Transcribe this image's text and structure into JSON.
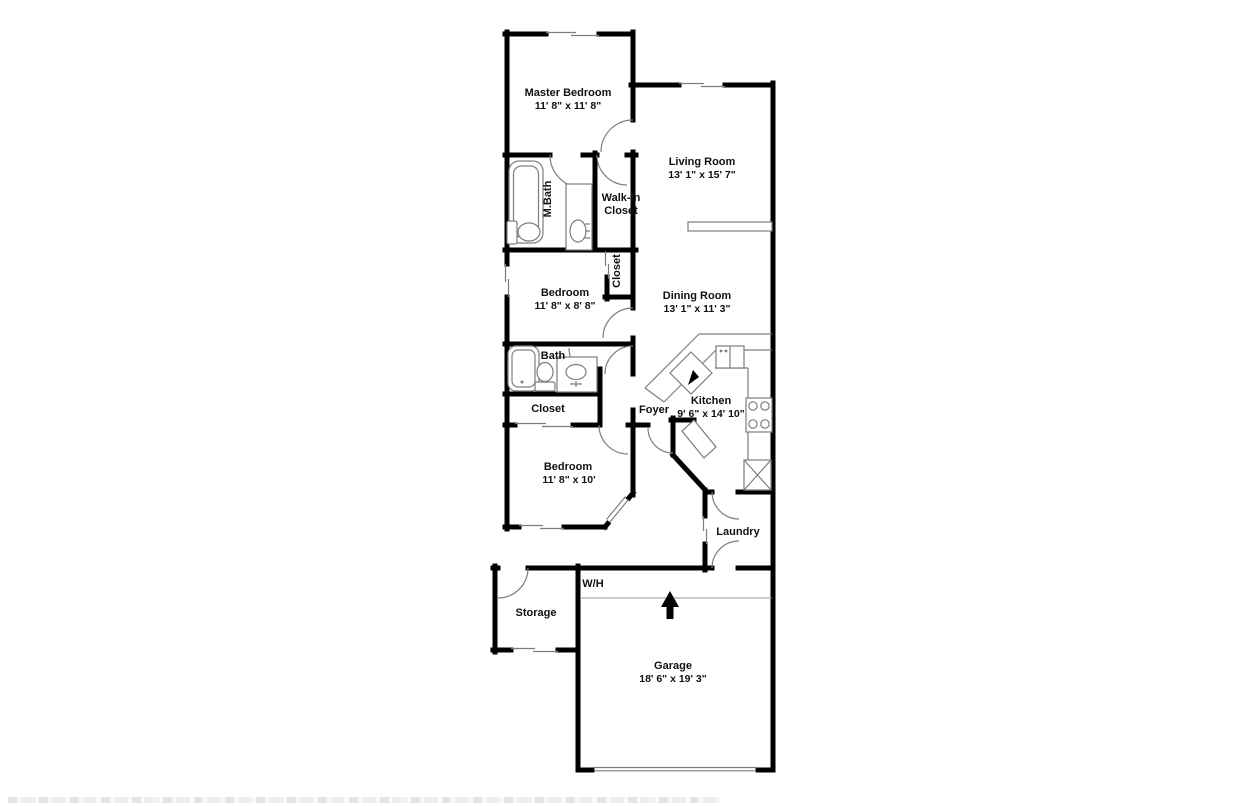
{
  "colors": {
    "background": "#ffffff",
    "wall": "#000000",
    "fixture_line": "#7d7d7d",
    "text": "#111111"
  },
  "rooms": {
    "master_bedroom": {
      "name": "Master Bedroom",
      "dims": "11' 8\" x 11' 8\""
    },
    "living_room": {
      "name": "Living Room",
      "dims": "13' 1\" x 15' 7\""
    },
    "master_bath": {
      "name": "M.Bath"
    },
    "walk_in_closet": {
      "line1": "Walk-In",
      "line2": "Closet"
    },
    "bedroom2_closet": {
      "name": "Closet"
    },
    "bedroom2": {
      "name": "Bedroom",
      "dims": "11' 8\" x 8' 8\""
    },
    "dining_room": {
      "name": "Dining Room",
      "dims": "13' 1\" x 11' 3\""
    },
    "bath": {
      "name": "Bath"
    },
    "hall_closet": {
      "name": "Closet"
    },
    "foyer": {
      "name": "Foyer"
    },
    "kitchen": {
      "name": "Kitchen",
      "dims": "9' 6\" x 14' 10\""
    },
    "bedroom3": {
      "name": "Bedroom",
      "dims": "11' 8\" x 10'"
    },
    "laundry": {
      "name": "Laundry"
    },
    "water_heater": {
      "name": "W/H"
    },
    "storage": {
      "name": "Storage"
    },
    "garage": {
      "name": "Garage",
      "dims": "18' 6\" x 19' 3\""
    }
  },
  "icons": {
    "north_arrow": "up-arrow",
    "fixtures": [
      "bathtub",
      "toilet",
      "vanity-sink",
      "kitchen-double-sink",
      "stove-4-burner",
      "counter",
      "pantry-x-cabinet",
      "plant-ledge",
      "door-swing-arc",
      "sliding-door",
      "window"
    ]
  }
}
